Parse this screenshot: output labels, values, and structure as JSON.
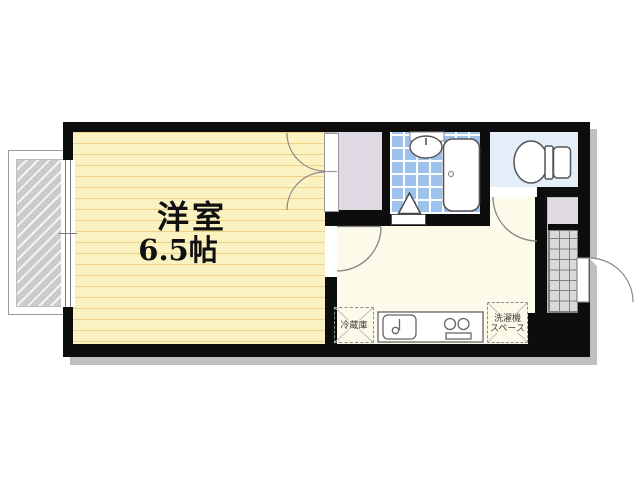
{
  "floor_plan": {
    "main_room": {
      "label": "洋室",
      "area": "6.5帖"
    },
    "kitchen": {
      "refrigerator_label": "冷蔵庫",
      "washer_space_label_line1": "洗濯機",
      "washer_space_label_line2": "スペース"
    },
    "fixtures": [
      "balcony",
      "sliding-window",
      "closet-double-doors",
      "bathtub",
      "bath-sink",
      "folding-bath-door",
      "toilet",
      "kitchen-sink",
      "two-burner-stove",
      "refrigerator-space",
      "washer-space",
      "genkan-tiles",
      "shoe-cabinet",
      "entry-door"
    ],
    "colors": {
      "wall": "#0d0d0d",
      "main_room_floor": "#fbf2c2",
      "main_room_lines": "#eed386",
      "kitchen_floor": "#fcfae8",
      "bathroom_tile": "#9fc2ec",
      "toilet_floor": "#e4eef9",
      "closet_fill": "#ded9e2",
      "genkan_tile": "#d9d9d9",
      "balcony_hatch": "#cbcbcb"
    }
  }
}
